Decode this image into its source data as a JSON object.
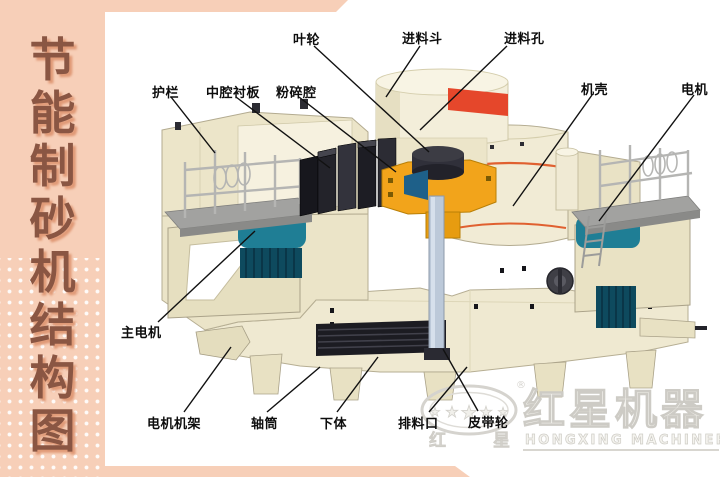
{
  "banner": {
    "chars": [
      "节",
      "能",
      "制",
      "砂",
      "机",
      "结",
      "构",
      "图"
    ],
    "full_title": "节能制砂机结构图"
  },
  "diagram": {
    "labels": [
      {
        "text": "叶轮"
      },
      {
        "text": "进料斗"
      },
      {
        "text": "进料孔"
      },
      {
        "text": "护栏"
      },
      {
        "text": "中腔衬板"
      },
      {
        "text": "粉碎腔"
      },
      {
        "text": "机壳"
      },
      {
        "text": "电机"
      },
      {
        "text": "主电机"
      },
      {
        "text": "电机机架"
      },
      {
        "text": "轴筒"
      },
      {
        "text": "下体"
      },
      {
        "text": "排料口"
      },
      {
        "text": "皮带轮"
      }
    ]
  },
  "logo": {
    "cn": "红星机器",
    "en": "HONGXING MACHINERY",
    "char_left": "红",
    "char_right": "星",
    "registered": "®",
    "stars": "★"
  },
  "palette": {
    "banner_bg": "#f7cfb8",
    "banner_text": "#8a5643",
    "label_text": "#0d0d0d",
    "machine_cream": "#efe9d1",
    "machine_outline": "#b3ab90",
    "hopper_red_band": "#e5472b",
    "shell_orange_stripe": "#e06030",
    "impeller_yellow": "#f2a41b",
    "motor_teal": "#1f7e95",
    "motor_teal_dark": "#0e4a5e",
    "deck_gray": "#a2a2a0",
    "shaft_blue_gray": "#bcc9d9",
    "dark_parts": "#23232a",
    "logo_gray": "#d5d3ce",
    "leader_line": "#111111"
  }
}
